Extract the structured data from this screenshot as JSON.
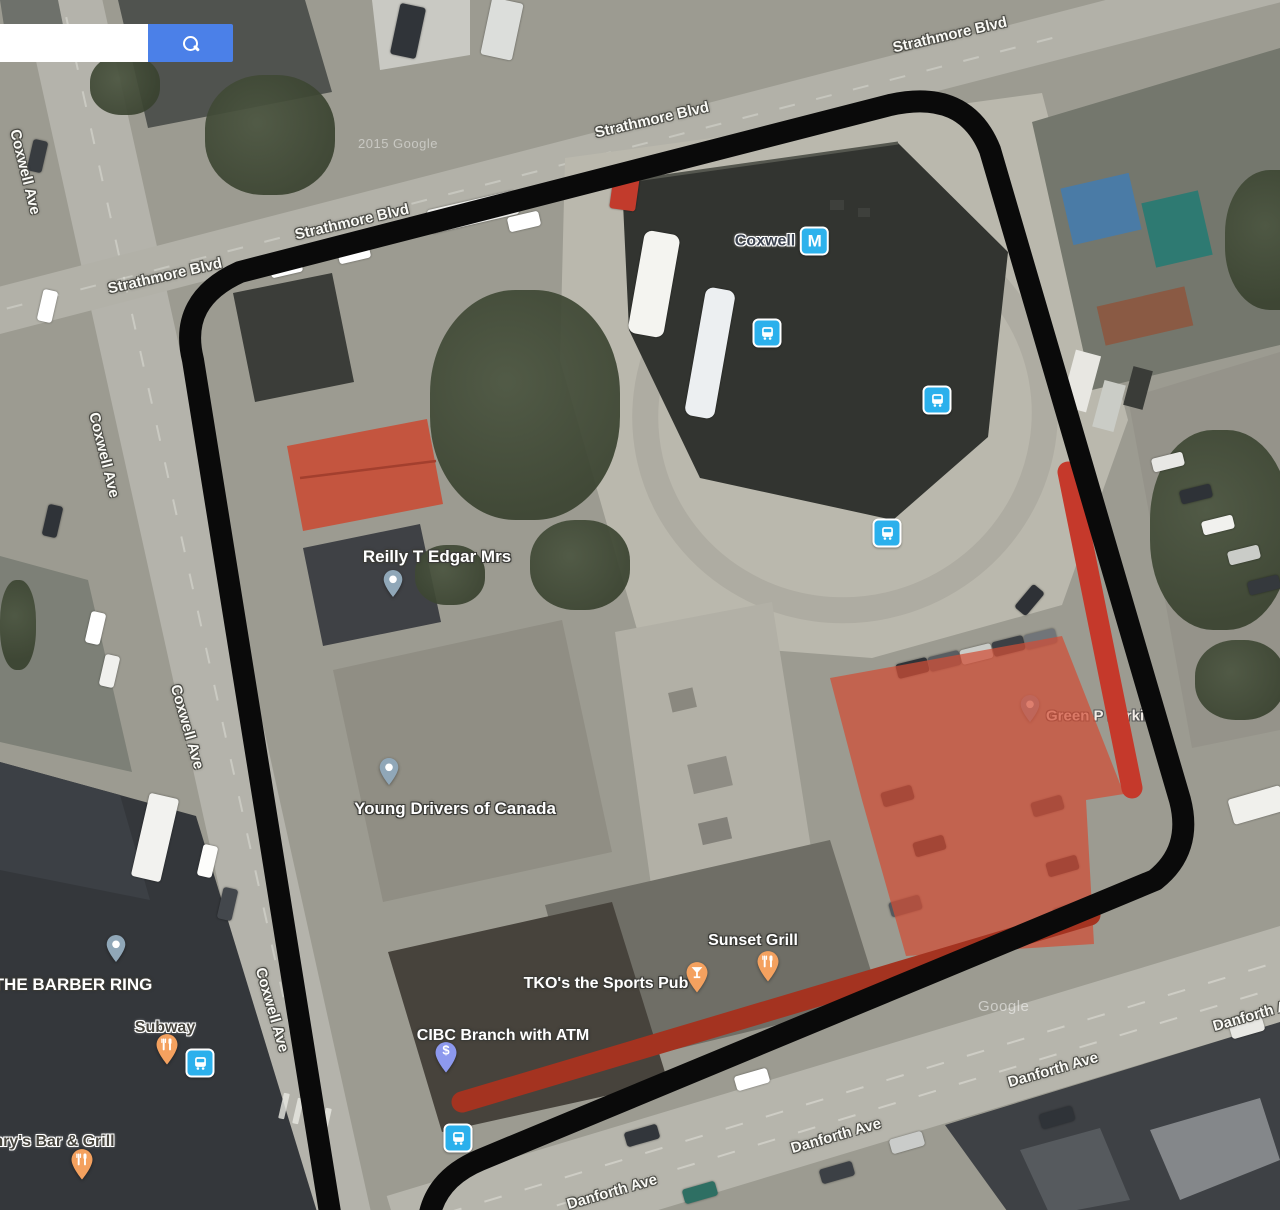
{
  "app": {
    "type": "google-maps-satellite-view"
  },
  "search": {
    "value": "",
    "button_icon": "magnifier-icon"
  },
  "station": {
    "label": "Coxwell",
    "icon_letter": "M",
    "icon": "subway-station-icon"
  },
  "streets": {
    "strathmore": "Strathmore Blvd",
    "coxwell": "Coxwell Ave",
    "danforth": "Danforth Ave"
  },
  "pois": {
    "reilly": "Reilly T Edgar Mrs",
    "young_drivers": "Young Drivers of Canada",
    "green_p": "Green P Parking",
    "barber": "THE BARBER RING",
    "subway": "Subway",
    "henrys": "nry's Bar & Grill",
    "tkos": "TKO's the Sports Pub",
    "sunset": "Sunset Grill",
    "cibc": "CIBC Branch with ATM",
    "cibc_icon_glyph": "$"
  },
  "transit_icons": {
    "bus_stop_count": 5,
    "icon": "bus-stop-icon"
  },
  "watermarks": {
    "year": "2015 Google",
    "google": "Google"
  },
  "annotations": {
    "route_outline_color": "#0a0a0a",
    "red_bar_color": "#c5392b",
    "red_stripe_color": "#a43320",
    "red_area_color": "#d14e36"
  },
  "colors": {
    "search_button": "#4b80e8",
    "transit_blue": "#2bb0ec",
    "pin_gray": "#90a7b8",
    "pin_orange": "#f4a15f",
    "pin_lavender": "#8d99ee"
  }
}
